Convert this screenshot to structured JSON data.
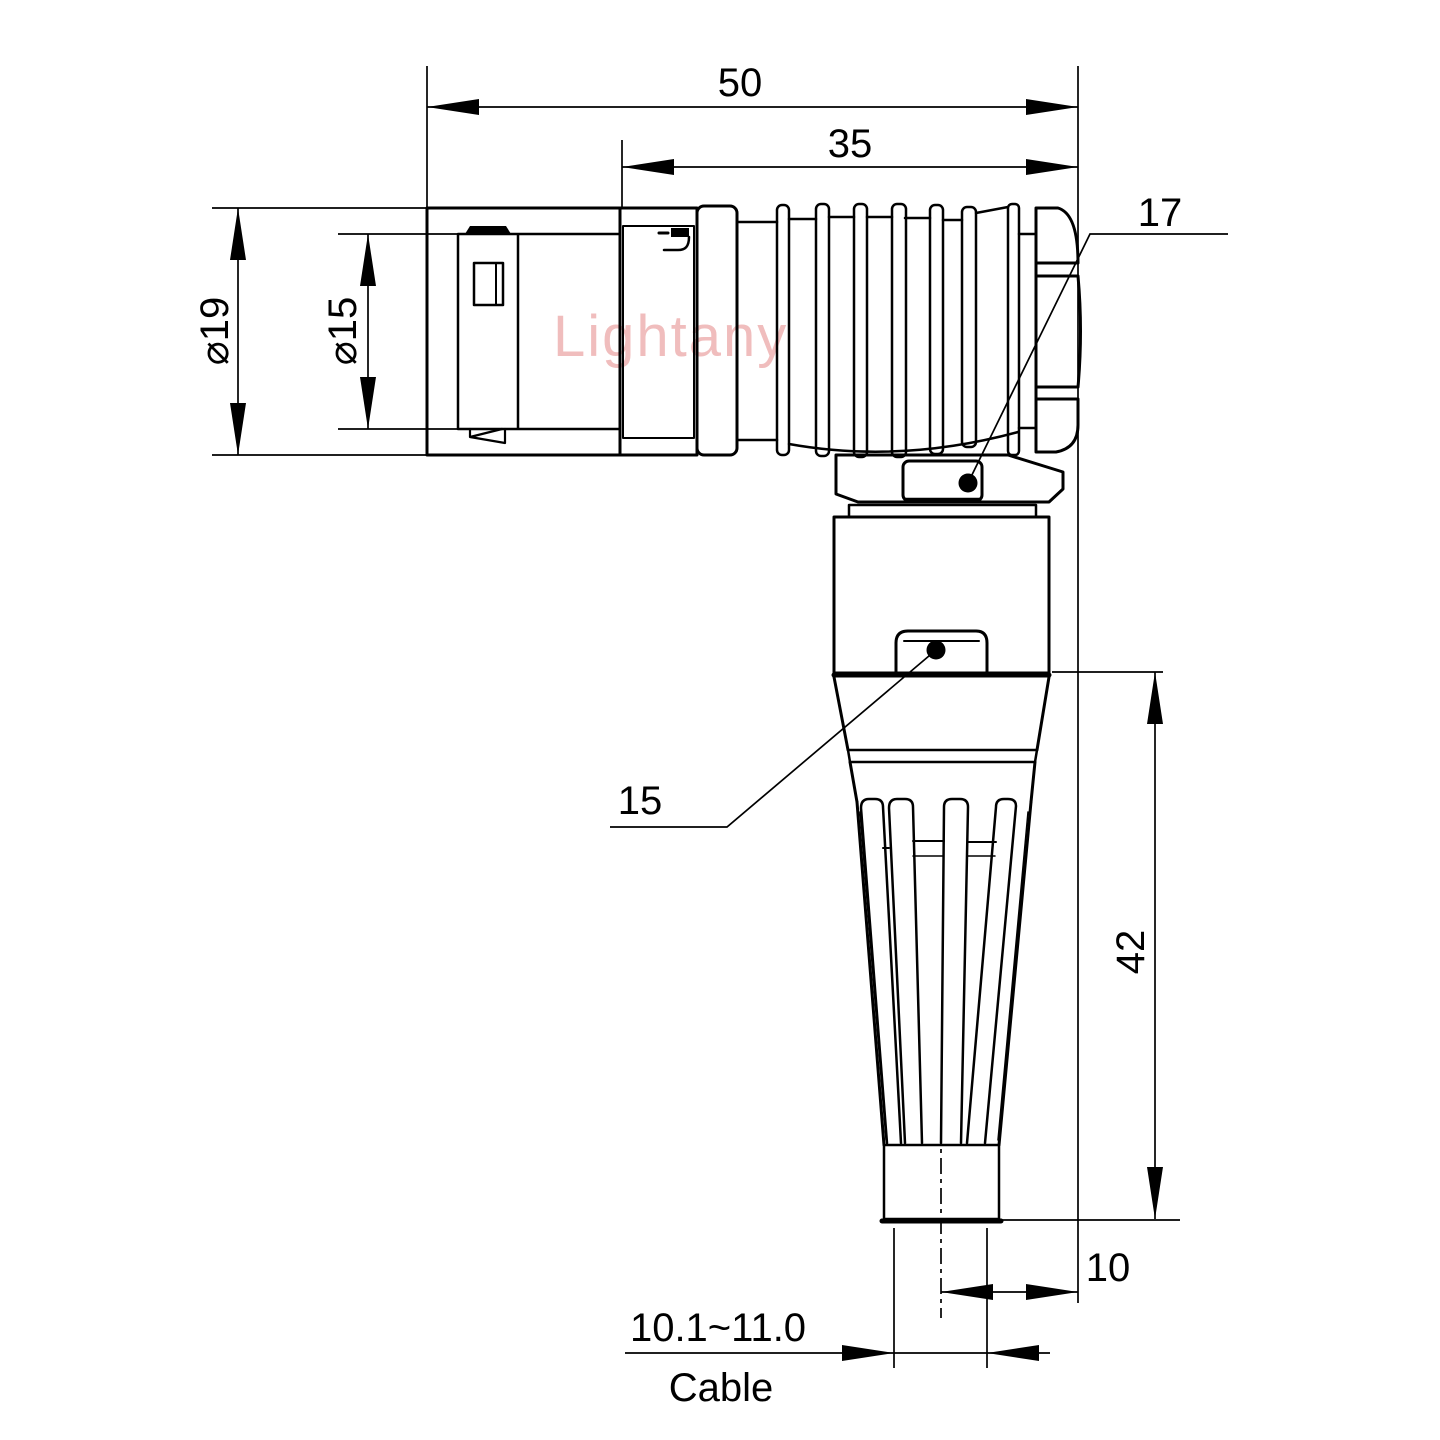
{
  "watermark": "Lightany",
  "colors": {
    "line": "#000000",
    "watermark": "#f0bdbd",
    "background": "#ffffff"
  },
  "dims": {
    "overall_length": "50",
    "rear_length": "35",
    "outer_diameter": "⌀19",
    "plug_diameter": "⌀15",
    "nut_across_flats": "17",
    "body_across_flats": "15",
    "vertical_length": "42",
    "cable_axis_offset": "10",
    "cable_diameter_range": "10.1~11.0",
    "cable_label": "Cable"
  }
}
